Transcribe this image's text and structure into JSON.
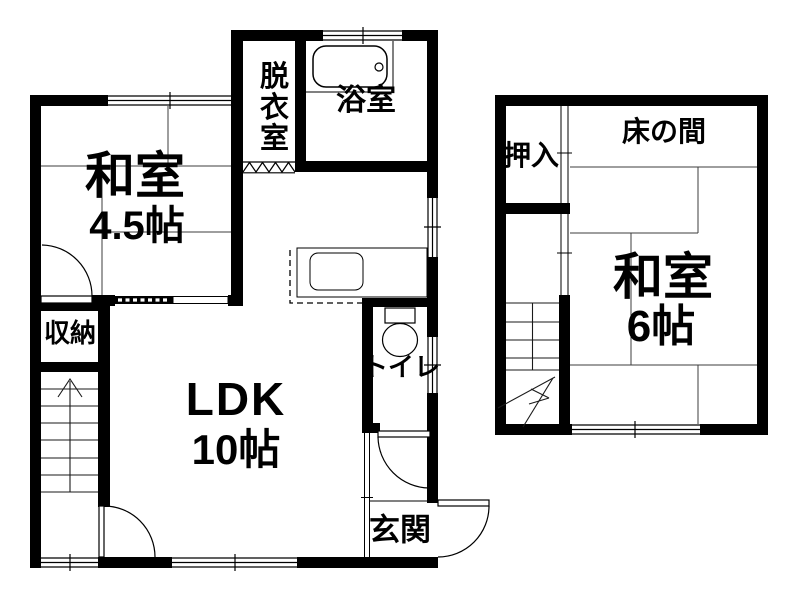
{
  "floor1": {
    "washitsu": {
      "label": "和室",
      "size": "4.5帖"
    },
    "datsuishitsu": {
      "label": "脱衣室"
    },
    "yokushitsu": {
      "label": "浴室"
    },
    "shunou": {
      "label": "収納"
    },
    "ldk": {
      "label": "LDK",
      "size": "10帖"
    },
    "toire": {
      "label": "トイレ"
    },
    "genkan": {
      "label": "玄関"
    }
  },
  "floor2": {
    "oshiire": {
      "label": "押入"
    },
    "tokonoma": {
      "label": "床の間"
    },
    "washitsu": {
      "label": "和室",
      "size": "6帖"
    }
  },
  "icons": {
    "bathtub": "bathtub-icon",
    "toilet": "toilet-icon",
    "kitchen_sink": "kitchen-sink-icon",
    "stairs_floor1": "stairs-up-icon",
    "stairs_floor2": "stairs-icon"
  },
  "colors": {
    "wall": "#000000",
    "background": "#ffffff",
    "tatami_line": "#3c3c3c"
  }
}
